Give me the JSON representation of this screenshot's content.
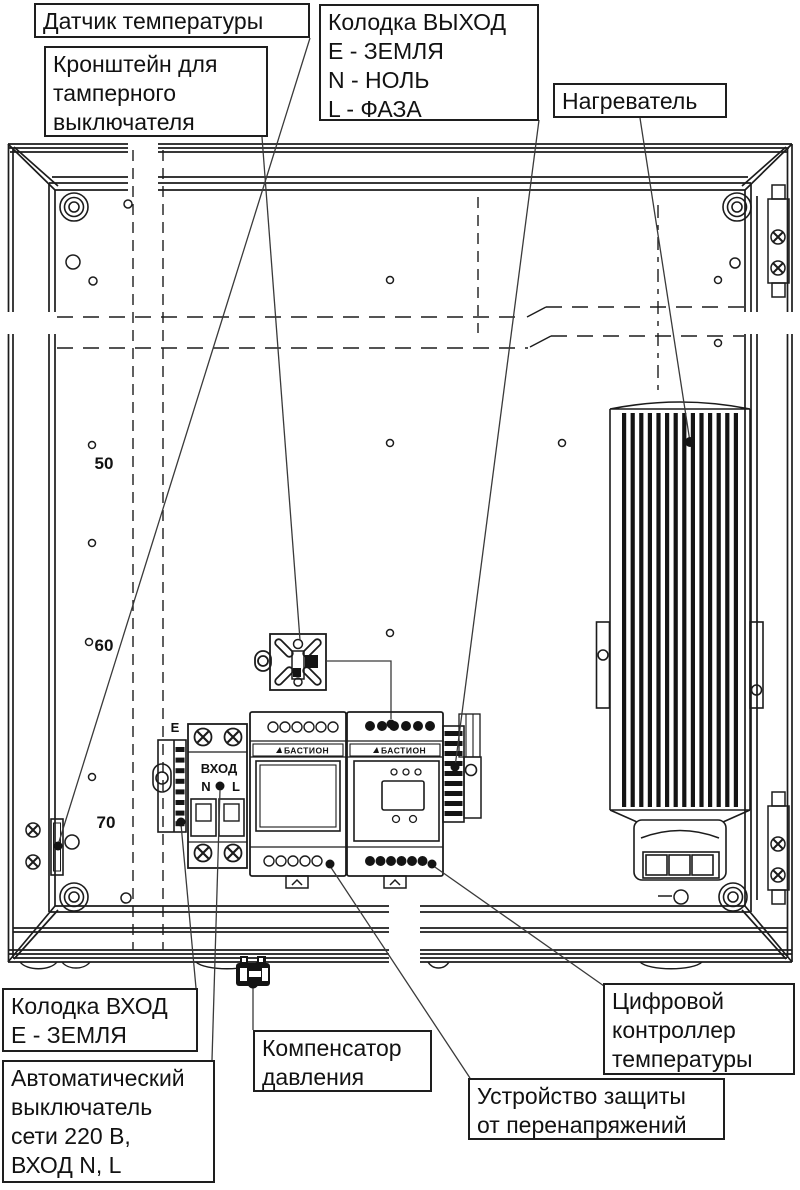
{
  "diagram": {
    "labels": {
      "temperature_sensor": "Датчик температуры",
      "tamper_bracket": "Кронштейн для\nтамперного\nвыключателя",
      "output_block": "Колодка ВЫХОД\nЕ - ЗЕМЛЯ\nN - НОЛЬ\nL - ФАЗА",
      "heater": "Нагреватель",
      "input_block": "Колодка ВХОД\nЕ - ЗЕМЛЯ",
      "breaker": "Автоматический\nвыключатель\nсети 220 В,\nВХОД N, L",
      "pressure_compensator": "Компенсатор\nдавления",
      "surge_protector": "Устройство защиты\nот перенапряжений",
      "temp_controller": "Цифровой\nконтроллер\nтемпературы"
    },
    "panel_marks": {
      "m50": "50",
      "m60": "60",
      "m70": "70"
    },
    "device_texts": {
      "input_e": "Е",
      "vhod": "ВХОД",
      "n": "N",
      "l": "L",
      "brand_left": "БАСТИОН",
      "brand_right": "БАСТИОН"
    },
    "colors": {
      "line": "#1c1c1c",
      "leader": "#3a3a3a",
      "background": "#ffffff"
    }
  }
}
